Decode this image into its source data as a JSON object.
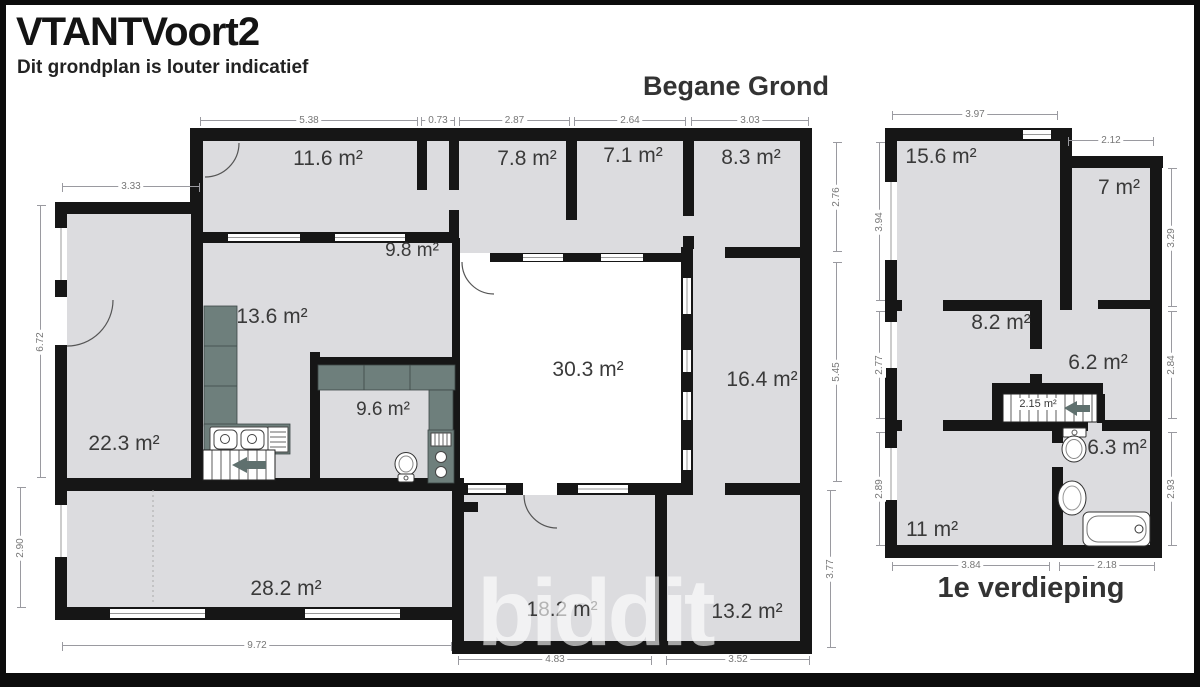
{
  "header": {
    "title": "VTANTVoort2",
    "subtitle": "Dit grondplan is louter indicatief"
  },
  "watermark": {
    "text": "biddit"
  },
  "ground_floor": {
    "title": "Begane Grond",
    "rooms": {
      "r11_6": "11.6 m²",
      "r7_8": "7.8 m²",
      "r7_1": "7.1 m²",
      "r8_3": "8.3 m²",
      "r9_8": "9.8 m²",
      "r13_6": "13.6 m²",
      "r30_3": "30.3 m²",
      "r16_4": "16.4 m²",
      "r22_3": "22.3 m²",
      "r9_6": "9.6 m²",
      "r28_2": "28.2 m²",
      "r18_2": "18.2 m²",
      "r13_2": "13.2 m²"
    },
    "dims": {
      "t_5_38": "5.38",
      "t_0_73": "0.73",
      "t_2_87": "2.87",
      "t_2_64": "2.64",
      "t_3_03": "3.03",
      "l_3_33": "3.33",
      "l_6_72": "6.72",
      "l_2_90": "2.90",
      "r_2_76": "2.76",
      "r_5_45": "5.45",
      "r_3_77": "3.77",
      "b_9_72": "9.72",
      "b_4_83": "4.83",
      "b_3_52": "3.52"
    }
  },
  "first_floor": {
    "title": "1e verdieping",
    "rooms": {
      "r15_6": "15.6 m²",
      "r7": "7 m²",
      "r8_2": "8.2 m²",
      "r6_2": "6.2 m²",
      "r2_15": "2.15 m²",
      "r6_3": "6.3 m²",
      "r11": "11 m²"
    },
    "dims": {
      "t_3_97": "3.97",
      "t_2_12": "2.12",
      "l_3_94": "3.94",
      "l_2_77": "2.77",
      "l_2_89": "2.89",
      "r_3_29": "3.29",
      "r_2_84": "2.84",
      "r_2_93": "2.93",
      "b_3_84": "3.84",
      "b_2_18": "2.18"
    }
  },
  "colors": {
    "wall": "#161616",
    "room_fill": "#dcdcdf",
    "central_room_fill": "#ffffff",
    "counter": "#6e7f7c",
    "dimension": "#9a9aa0",
    "label_text": "#3a3a3a"
  }
}
